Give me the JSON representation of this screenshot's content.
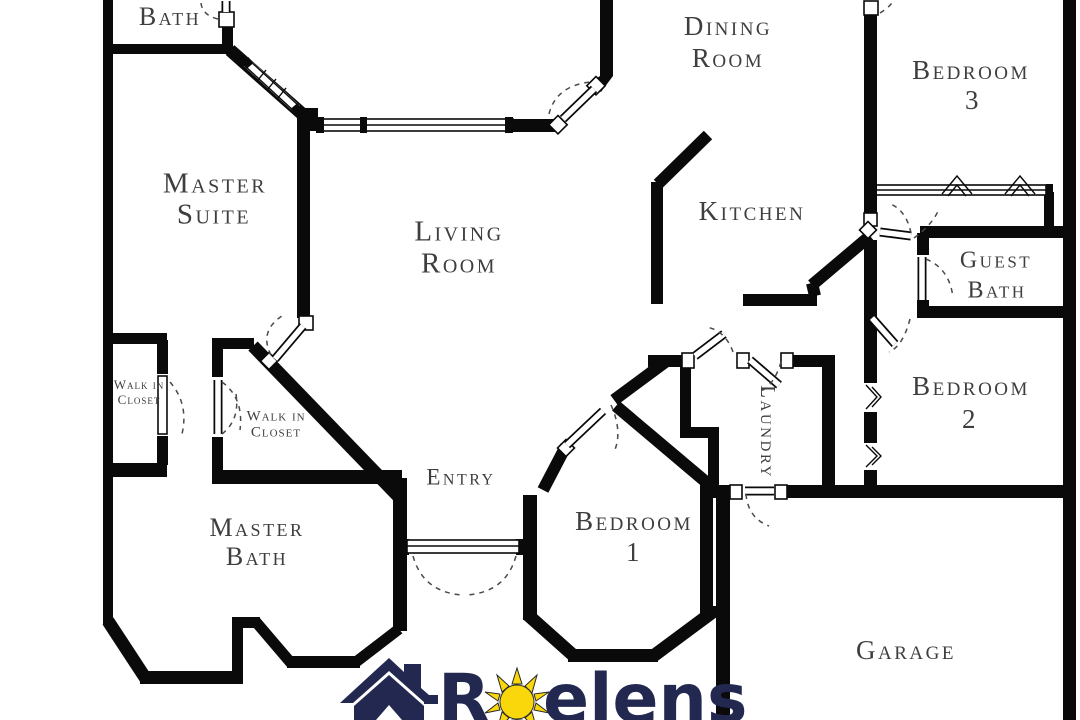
{
  "plan": {
    "rooms": {
      "bath": {
        "label": "Bath"
      },
      "master_suite": {
        "label": "Master Suite",
        "lines": [
          "Master",
          "Suite"
        ]
      },
      "living_room": {
        "label": "Living Room",
        "lines": [
          "Living",
          "Room"
        ]
      },
      "dining_room": {
        "label": "Dining Room",
        "lines": [
          "Dining",
          "Room"
        ]
      },
      "kitchen": {
        "label": "Kitchen"
      },
      "bedroom3": {
        "label": "Bedroom 3",
        "lines": [
          "Bedroom",
          "3"
        ]
      },
      "guest_bath": {
        "label": "Guest Bath",
        "lines": [
          "Guest",
          "Bath"
        ]
      },
      "bedroom2": {
        "label": "Bedroom 2",
        "lines": [
          "Bedroom",
          "2"
        ]
      },
      "laundry": {
        "label": "Laundry"
      },
      "closet_left": {
        "label": "Walk in Closet",
        "lines": [
          "Walk in",
          "Closet"
        ]
      },
      "closet_right": {
        "label": "Walk in Closet",
        "lines": [
          "Walk in",
          "Closet"
        ]
      },
      "entry": {
        "label": "Entry"
      },
      "master_bath": {
        "label": "Master Bath",
        "lines": [
          "Master",
          "Bath"
        ]
      },
      "bedroom1": {
        "label": "Bedroom 1",
        "lines": [
          "Bedroom",
          "1"
        ]
      },
      "garage": {
        "label": "Garage"
      }
    }
  },
  "logo": {
    "brand_first_letter": "R",
    "brand_rest": "elens",
    "icons": [
      "house-icon",
      "sun-icon"
    ]
  },
  "colors": {
    "wall": "#0a0a0a",
    "label_text": "#3e3e3e",
    "logo_navy": "#232850",
    "sun_yellow": "#f9d70b",
    "background": "#ffffff"
  }
}
